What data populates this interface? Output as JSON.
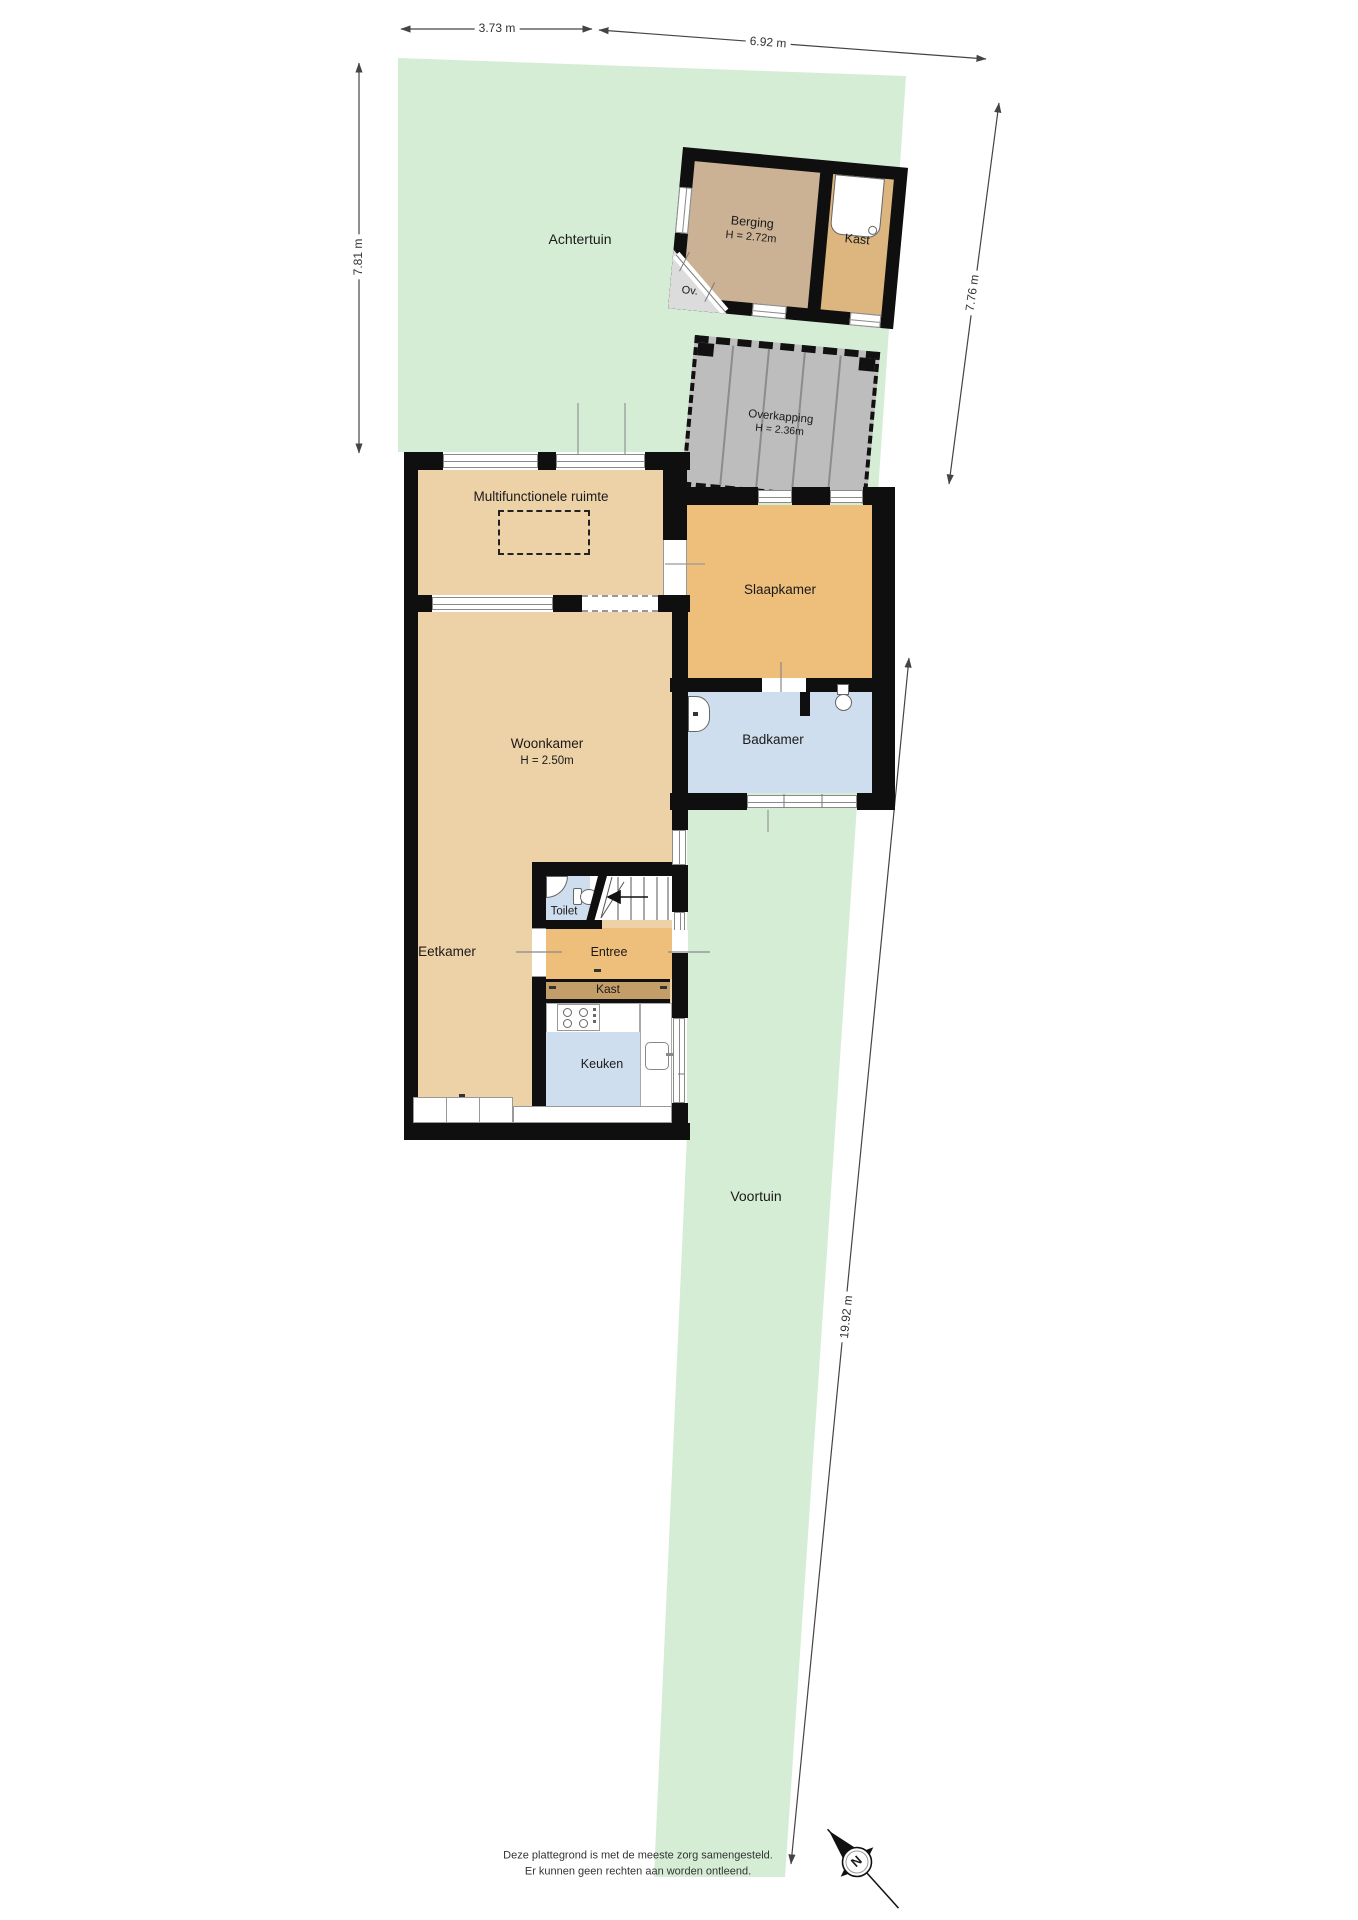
{
  "dims": {
    "top_left": "3.73 m",
    "top_right": "6.92 m",
    "left": "7.81 m",
    "right": "7.76 m",
    "front": "19.92 m"
  },
  "garden": {
    "back": "Achtertuin",
    "front": "Voortuin"
  },
  "outbuilding": {
    "berging_name": "Berging",
    "berging_height": "H = 2.72m",
    "kast": "Kast",
    "ov": "Ov."
  },
  "canopy": {
    "name": "Overkapping",
    "height": "H = 2.36m"
  },
  "rooms": {
    "multifunctional": "Multifunctionele ruimte",
    "bedroom": "Slaapkamer",
    "bathroom": "Badkamer",
    "living_name": "Woonkamer",
    "living_height": "H = 2.50m",
    "dining": "Eetkamer",
    "toilet": "Toilet",
    "entry": "Entree",
    "closet": "Kast",
    "kitchen": "Keuken"
  },
  "compass": {
    "north": "N"
  },
  "footer": {
    "line1": "Deze plattegrond is met de meeste zorg samengesteld.",
    "line2": "Er kunnen geen rechten aan worden ontleend."
  },
  "colors": {
    "wall": "#0f0f0f",
    "garden": "#d5edd5",
    "floor_tan": "#edd2a8",
    "floor_orange": "#eebe7b",
    "floor_blue": "#cfdeee",
    "closet_strip": "#c39e68",
    "berging_floor": "#cbb294",
    "kast_floor": "#dcb67e",
    "canopy": "#bdbdbd"
  }
}
